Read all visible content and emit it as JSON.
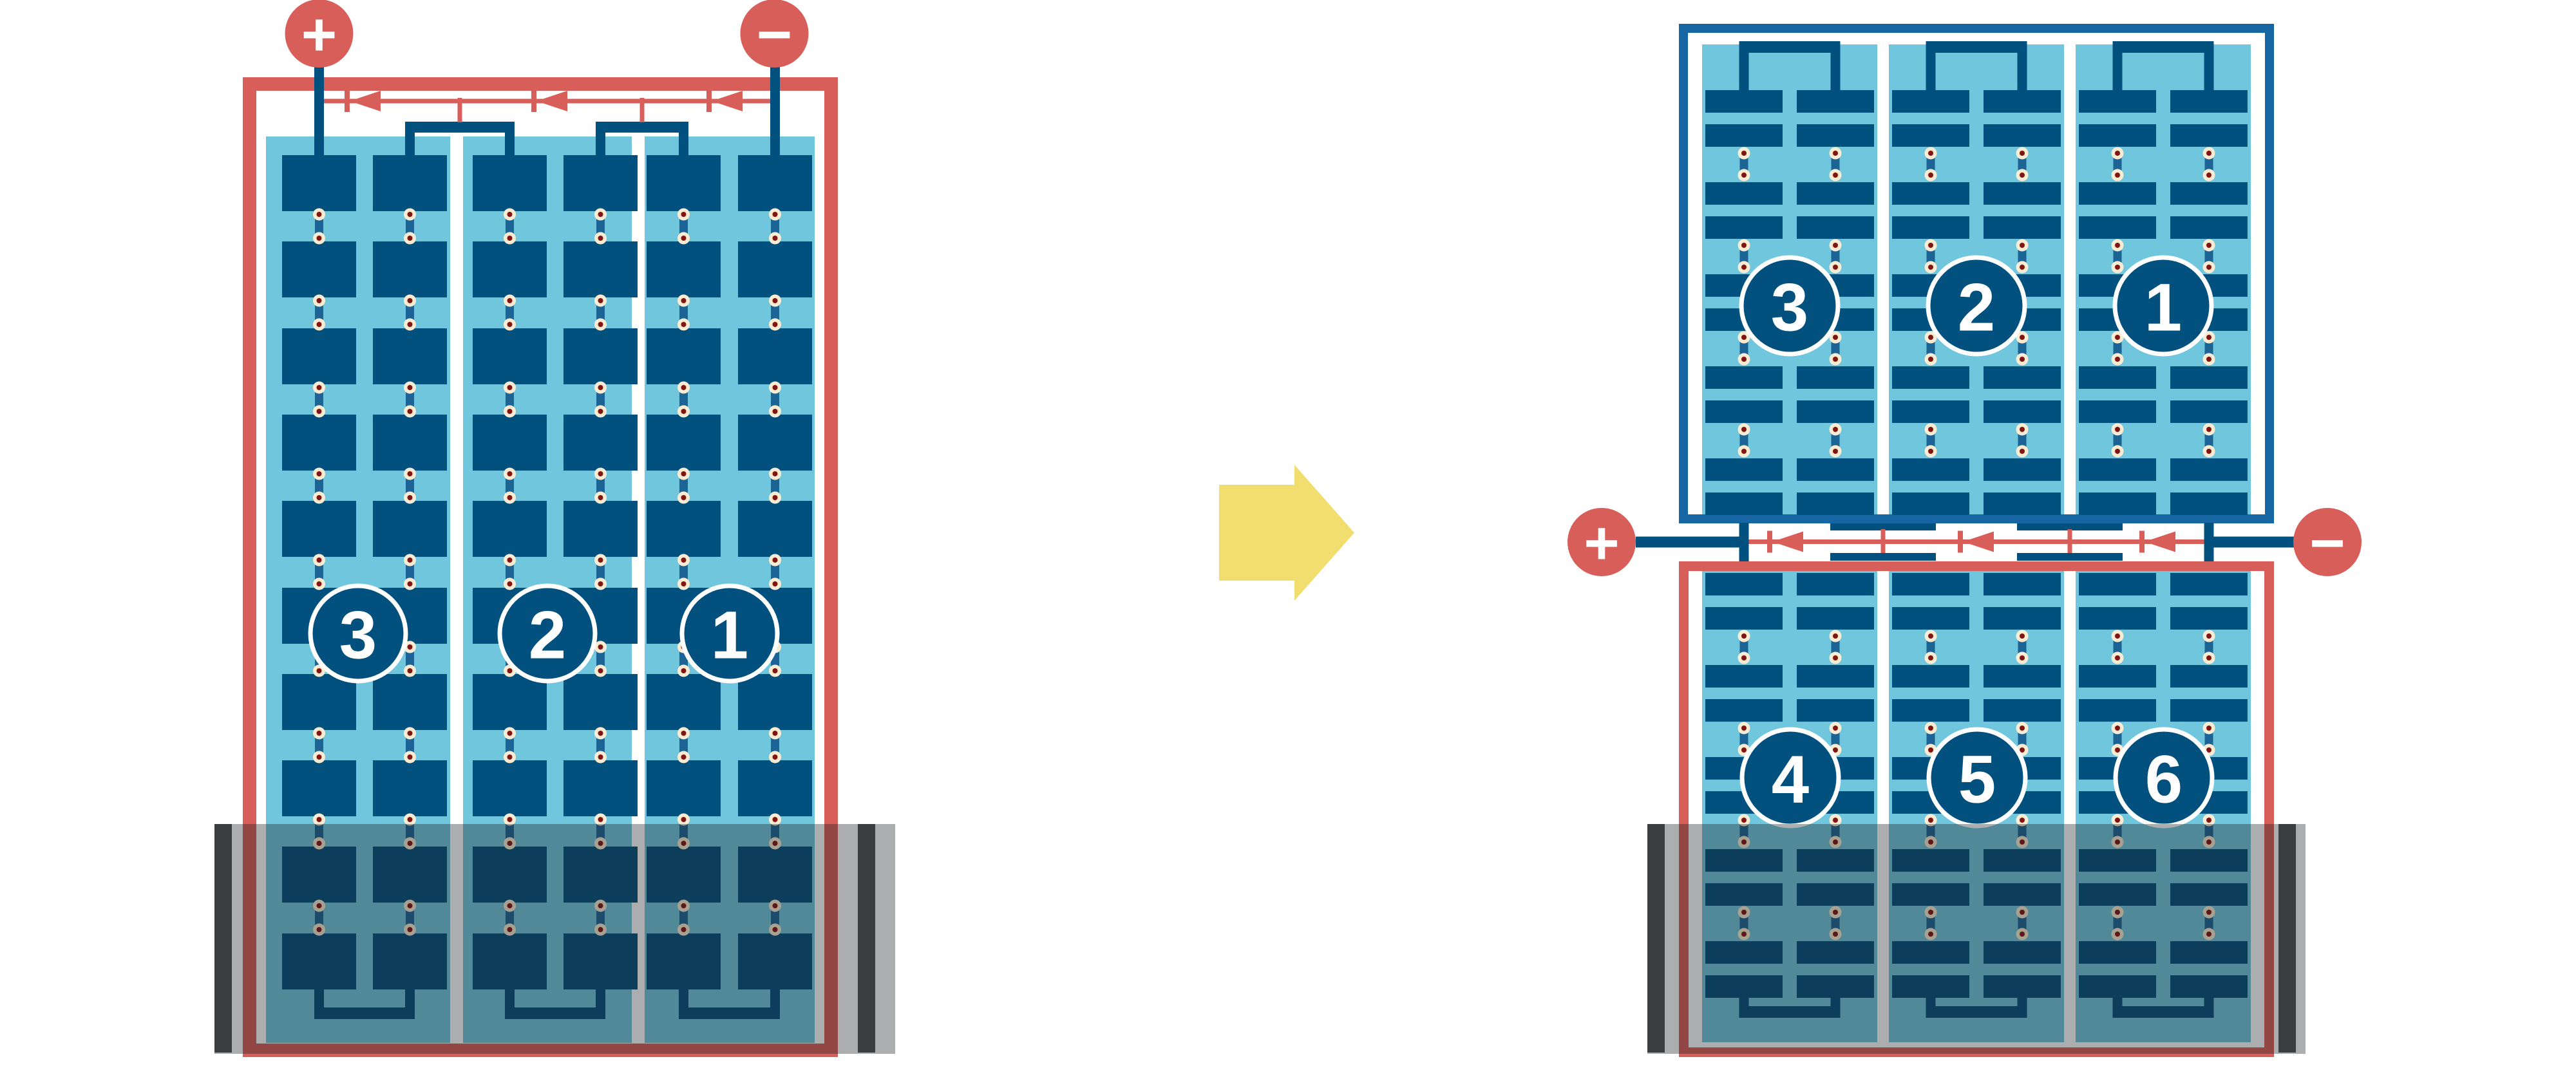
{
  "terminals": {
    "positive": "+",
    "negative": "−"
  },
  "left_module": {
    "string_labels": [
      "3",
      "2",
      "1"
    ]
  },
  "right_module": {
    "top_labels": [
      "3",
      "2",
      "1"
    ],
    "bottom_labels": [
      "4",
      "5",
      "6"
    ]
  },
  "colors": {
    "red": "#D85E5A",
    "navy": "#02507E",
    "frame_blue": "#1566A2",
    "light_blue": "#70C7DD",
    "solder_cream": "#F9ECD2",
    "solder_dot": "#801511",
    "joint_stub_blue": "#1D6496",
    "shade_overlay": "rgba(30,32,34,0.37)",
    "shade_wall": "#3A3E40",
    "arrow_yellow": "#F2DE6E",
    "background": "#FFFFFF",
    "label_text": "#FFFFFF"
  }
}
